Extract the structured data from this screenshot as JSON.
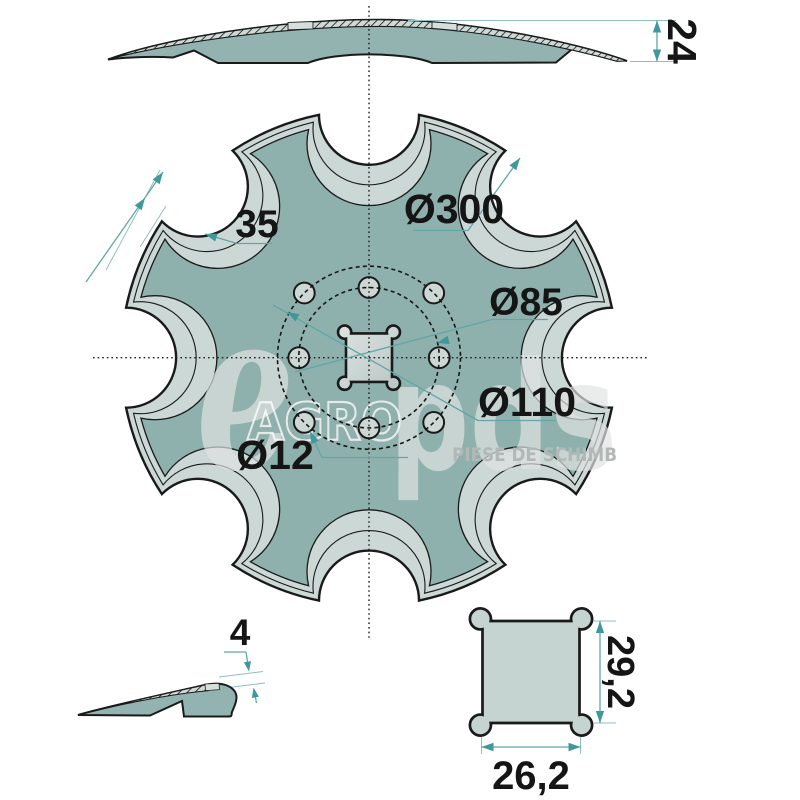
{
  "drawing": {
    "dimensions": {
      "stack_height": "24",
      "notch_depth": "35",
      "outer_diameter": "Ø300",
      "inner_bolt_circle_diameter": "Ø85",
      "outer_bolt_circle_diameter": "Ø110",
      "bolt_hole_diameter": "Ø12",
      "blade_thickness": "4",
      "square_hole_height": "29,2",
      "square_hole_width": "26,2"
    }
  },
  "watermark": {
    "initial": "e",
    "brand": "AGRO",
    "logo": "pds",
    "tagline": "PIESE DE SCHIMB"
  },
  "colors": {
    "background": "#ffffff",
    "disc_fill": "#8fb1ae",
    "edge_band": "#cbd8d5",
    "band_gap": "#d5dfdc",
    "hole_fill": "#cdd8d5",
    "detail_fill": "#c6d4d1",
    "line": "#1a1a1a",
    "dimension_accent": "#3f989b",
    "watermark_gray": "#b2b8b6"
  }
}
